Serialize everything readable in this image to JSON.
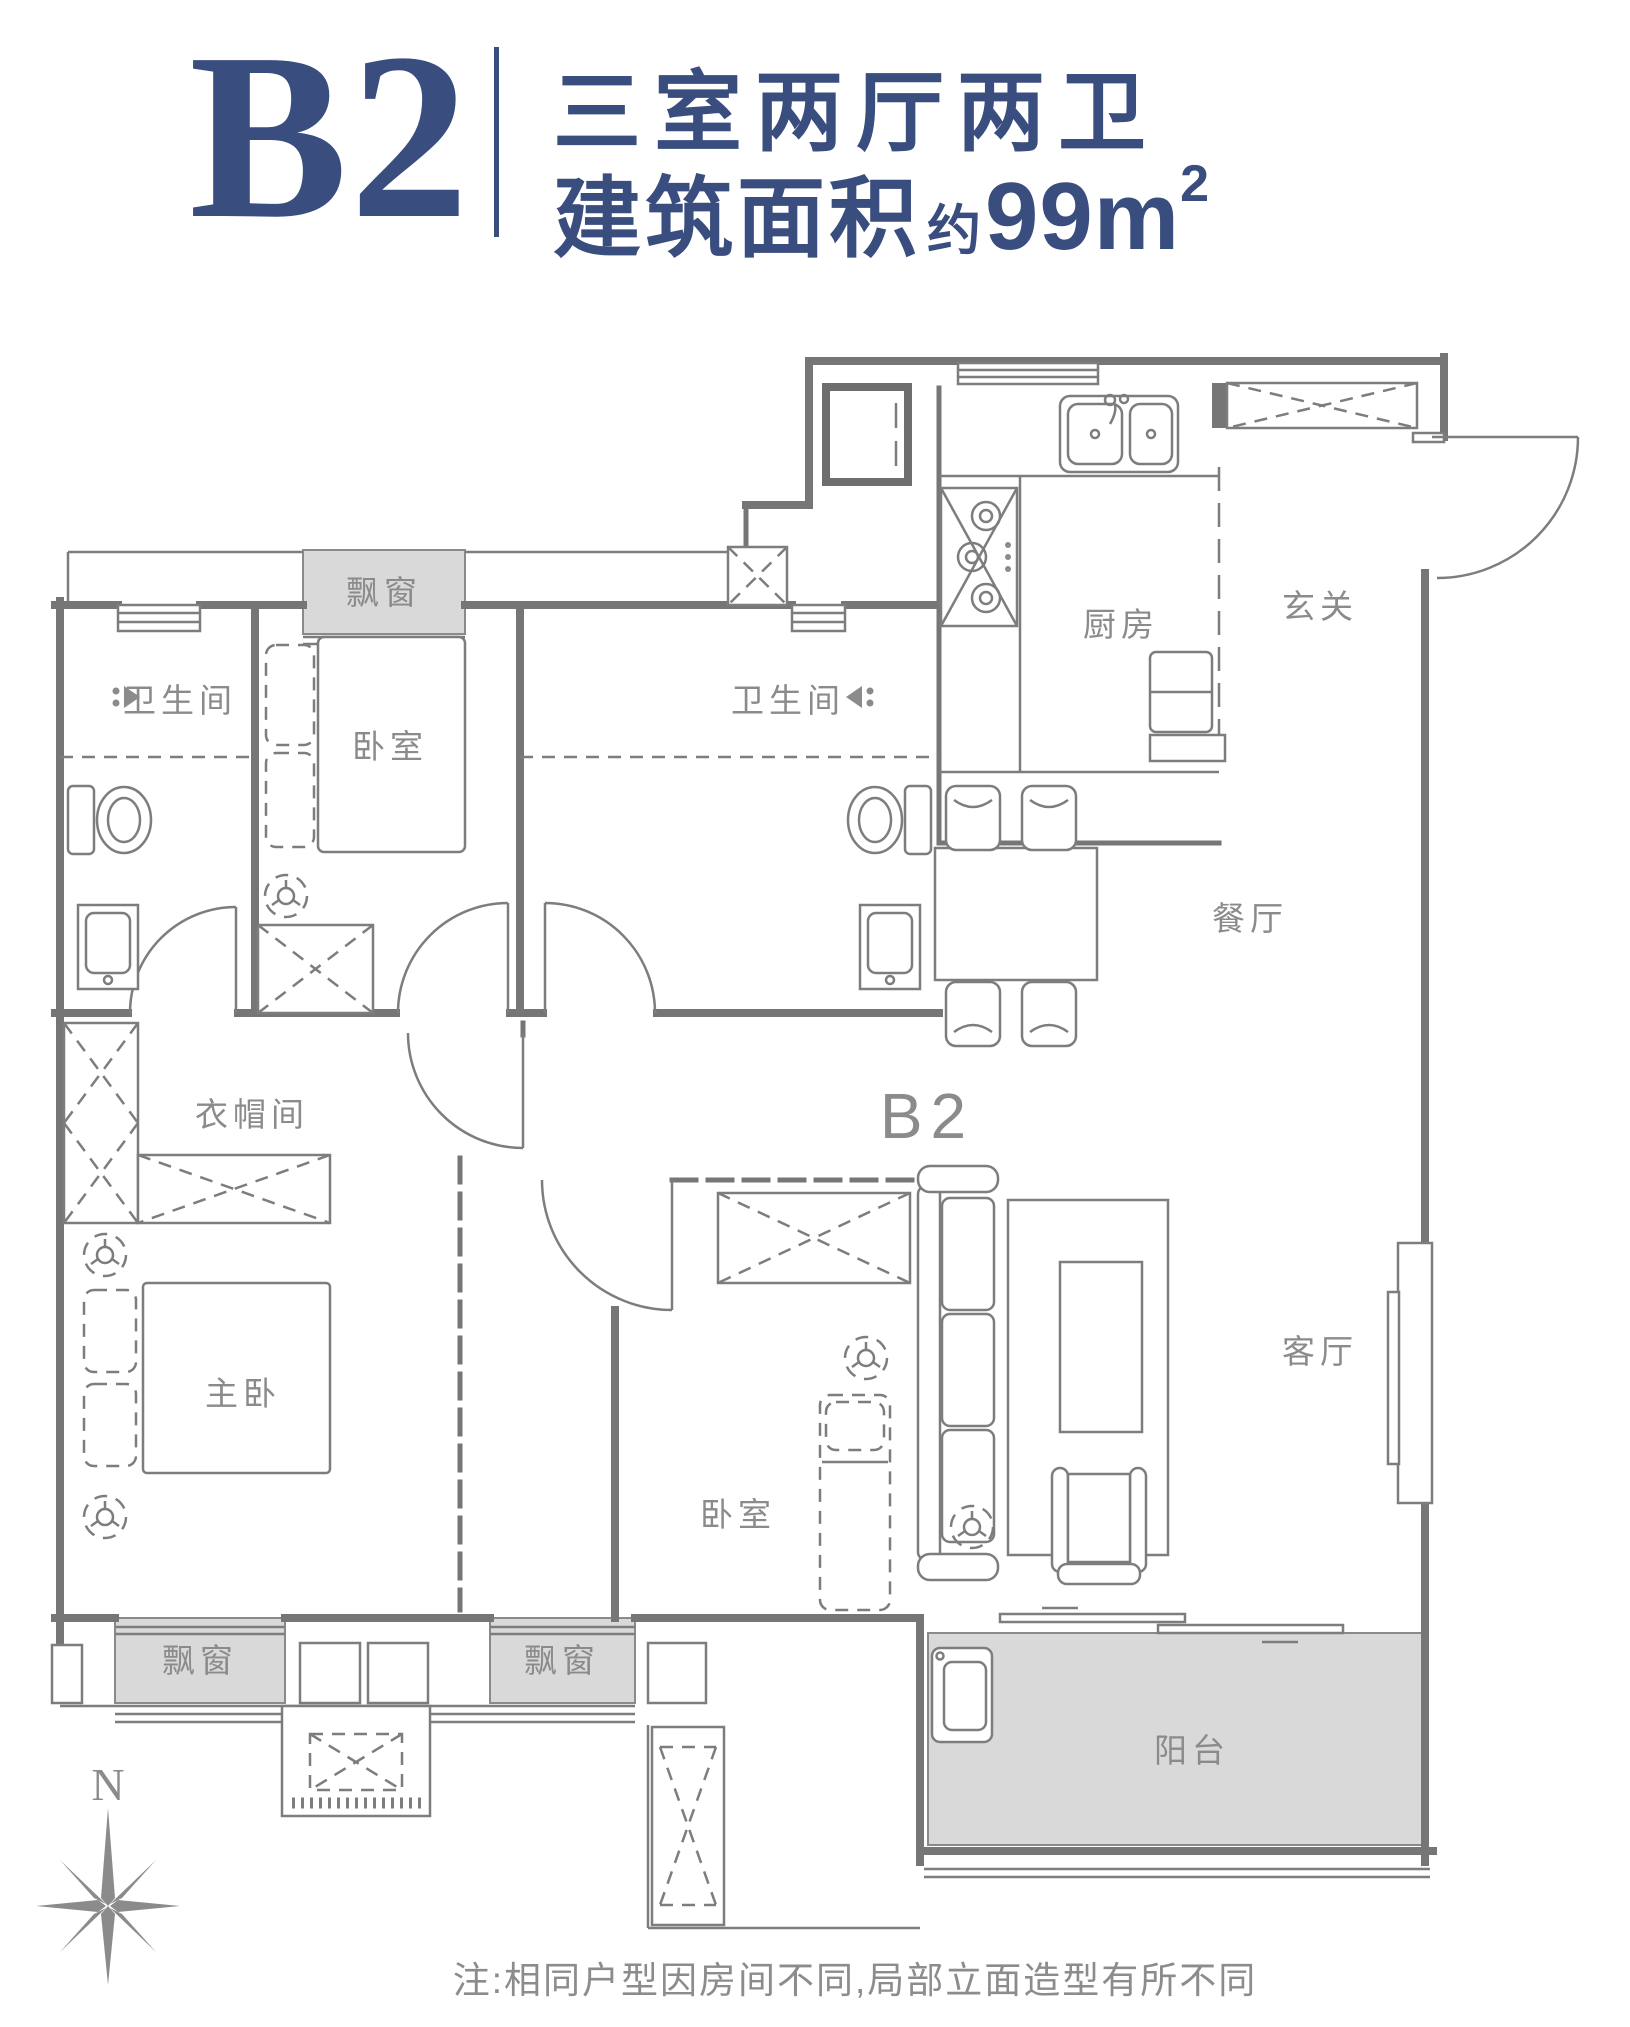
{
  "header": {
    "unit": "B2",
    "layout": "三室两厅两卫",
    "area_label": "建筑面积",
    "area_approx": "约",
    "area_value": "99m",
    "area_exp": "2"
  },
  "plan": {
    "label": "B2",
    "rooms": {
      "bath1": "卫生间",
      "bedroom1": "卧室",
      "bath2": "卫生间",
      "kitchen": "厨房",
      "foyer": "玄关",
      "dining": "餐厅",
      "cloakroom": "衣帽间",
      "master": "主卧",
      "bedroom2": "卧室",
      "living": "客厅",
      "balcony": "阳台"
    },
    "bays": [
      "飘窗",
      "飘窗",
      "飘窗"
    ],
    "compass": "N"
  },
  "note": "注:相同户型因房间不同,局部立面造型有所不同",
  "colors": {
    "accent": "#3a4d7f",
    "wall": "#767676",
    "label": "#8b8b8b",
    "fill": "#d9d9d9"
  }
}
